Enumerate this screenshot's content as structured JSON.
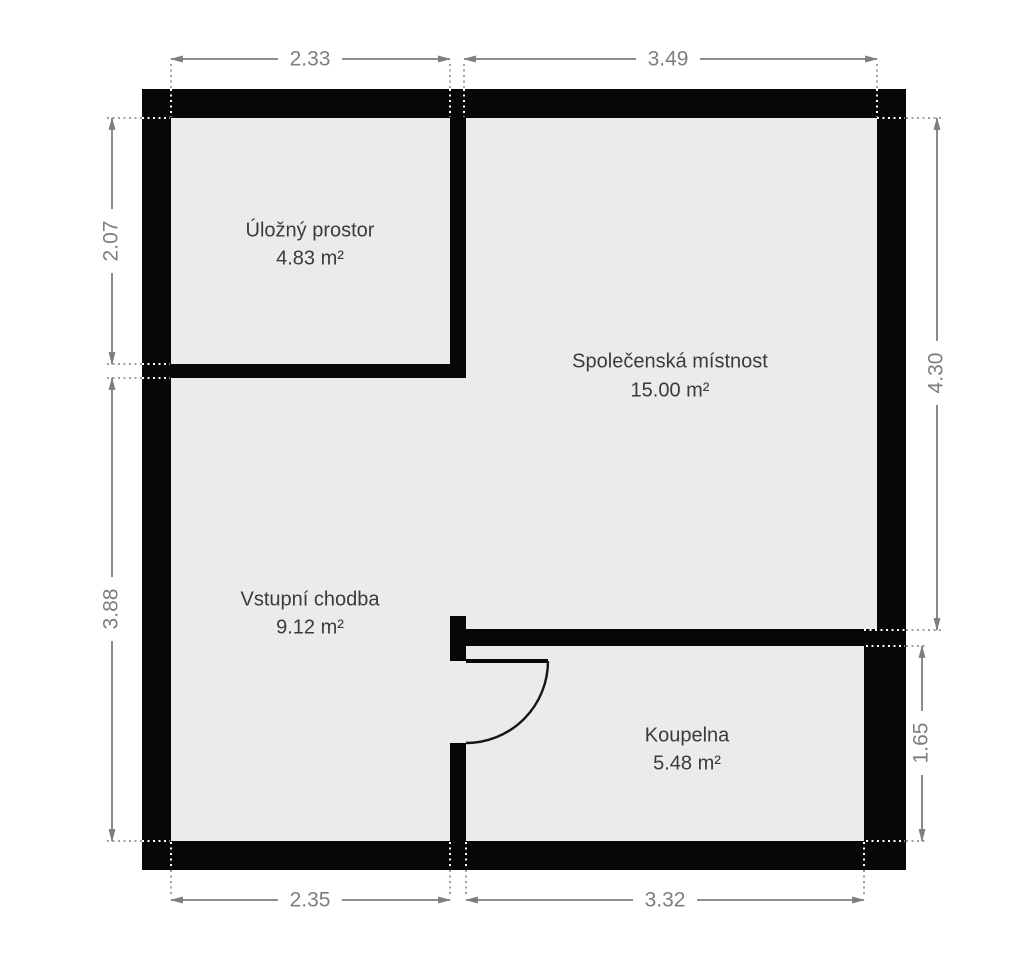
{
  "rooms": [
    {
      "name": "Úložný prostor",
      "area": "4.83 m²"
    },
    {
      "name": "Společenská místnost",
      "area": "15.00 m²"
    },
    {
      "name": "Vstupní chodba",
      "area": "9.12 m²"
    },
    {
      "name": "Koupelna",
      "area": "5.48 m²"
    }
  ],
  "dimensions": {
    "top": [
      "2.33",
      "3.49"
    ],
    "bottom": [
      "2.35",
      "3.32"
    ],
    "left": [
      "2.07",
      "3.88"
    ],
    "right": [
      "4.30",
      "1.65"
    ]
  },
  "colors": {
    "wall": "#070707",
    "floor": "#eaebec",
    "dimension": "#7e7e7e",
    "room_text": "#3b3b3b",
    "background": "#ffffff"
  }
}
